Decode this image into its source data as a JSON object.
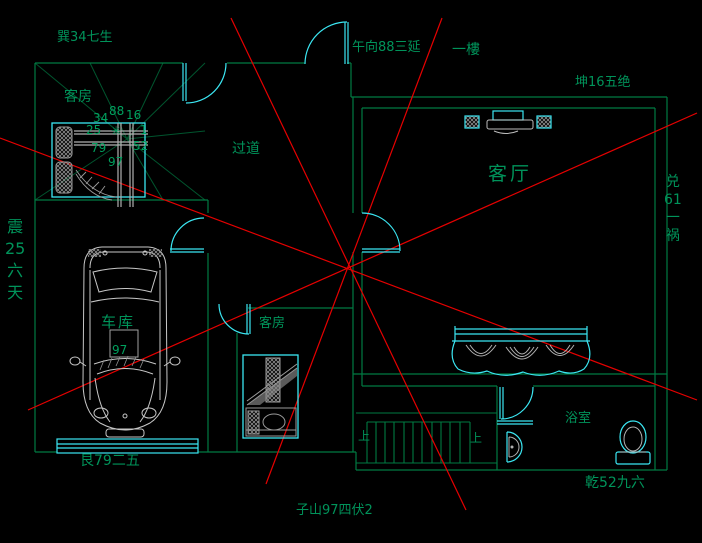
{
  "palette": {
    "background": "#000000",
    "wall_green": "#007a42",
    "text_green": "#00935a",
    "fan_line_green": "#00552e",
    "fixture_cyan": "#3be6f2",
    "analysis_red": "#e60000",
    "furniture_gray": "#c7c7c7"
  },
  "labels": {
    "xun": "巽34七生",
    "noon": "午向88三延",
    "floor": "一樓",
    "kun": "坤16五绝",
    "room1": "客房",
    "hallway": "过道",
    "living": "客厅",
    "garage": "车库",
    "room2": "客房",
    "gen": "艮79二五",
    "zishan": "子山97四伏2",
    "qian": "乾52九六",
    "bath": "浴室",
    "up_left": "上",
    "up_right": "上",
    "car_num": "97"
  },
  "vertical_labels": {
    "zhen": [
      "震",
      "25",
      "六",
      "天"
    ],
    "dui": [
      "兑",
      "61",
      "一",
      "祸"
    ]
  },
  "star_grid": {
    "r1c1": "34",
    "r1c2": "88",
    "r1c3": "16",
    "r2c1": "25",
    "r2c2": "✳",
    "r2c3": "1",
    "r3c1": "79",
    "r3c2": "97",
    "r3c3": "52"
  }
}
